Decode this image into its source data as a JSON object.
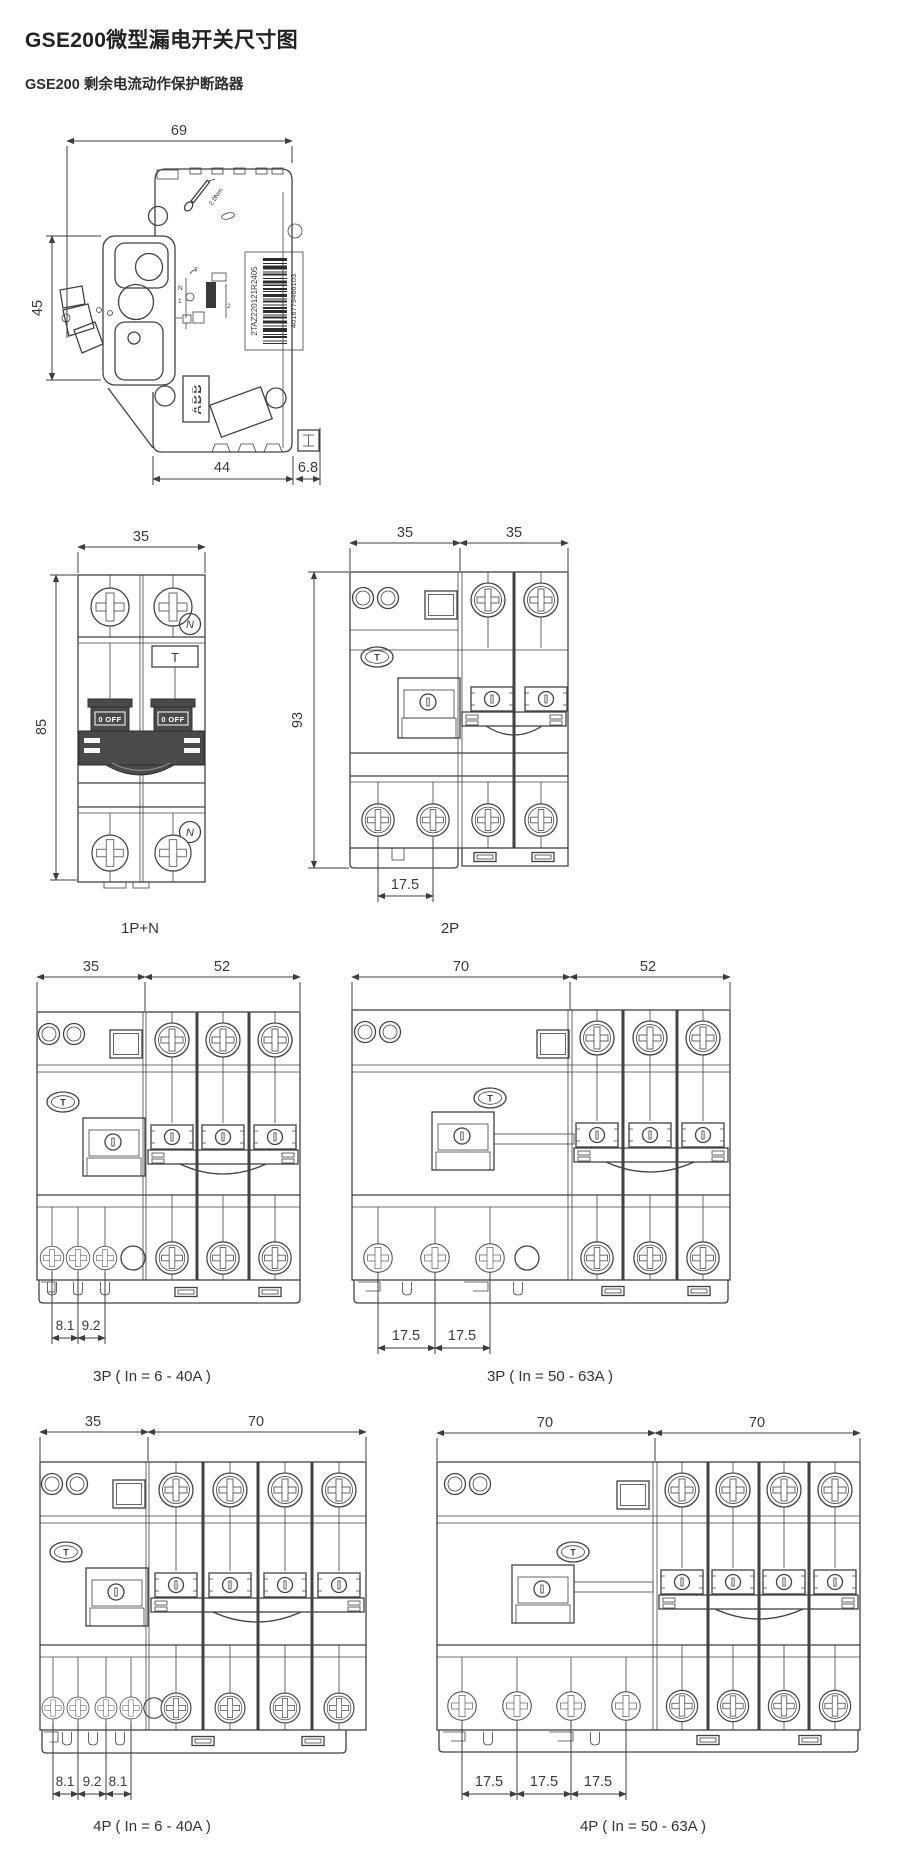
{
  "page": {
    "title": "GSE200微型漏电开关尺寸图",
    "subtitle": "GSE200 剩余电流动作保护断路器"
  },
  "colors": {
    "line": "#424242",
    "dark_fill": "#4a4a4a",
    "text": "#333333"
  },
  "side_view": {
    "dim_width": "69",
    "dim_height": "45",
    "dim_base": "44",
    "dim_rail": "6.8",
    "torque_label": "2.0Nm",
    "brand": "ABB",
    "barcode_code": "2TAZ220121R2405",
    "barcode_number": "4016779466103",
    "schematic": {
      "t": "T",
      "n": "N",
      "l1": "1",
      "l2": "2"
    }
  },
  "front_views": [
    {
      "label": "1P+N",
      "dims_top": [
        "35"
      ],
      "dim_height": "85",
      "dims_bottom": [],
      "neutral_badge": "N",
      "test_button": "T",
      "toggle_label": "0 OFF"
    },
    {
      "label": "2P",
      "dims_top": [
        "35",
        "35"
      ],
      "dim_height": "93",
      "dims_bottom": [
        "17.5"
      ]
    },
    {
      "label": "3P ( In = 6 - 40A )",
      "dims_top": [
        "35",
        "52"
      ],
      "dims_bottom": [
        "8.1",
        "9.2"
      ]
    },
    {
      "label": "3P ( In = 50 - 63A )",
      "dims_top": [
        "70",
        "52"
      ],
      "dims_bottom": [
        "17.5",
        "17.5"
      ]
    },
    {
      "label": "4P ( In = 6 - 40A )",
      "dims_top": [
        "35",
        "70"
      ],
      "dims_bottom": [
        "8.1",
        "9.2",
        "8.1"
      ]
    },
    {
      "label": "4P ( In = 50 - 63A )",
      "dims_top": [
        "70",
        "70"
      ],
      "dims_bottom": [
        "17.5",
        "17.5",
        "17.5"
      ]
    }
  ]
}
